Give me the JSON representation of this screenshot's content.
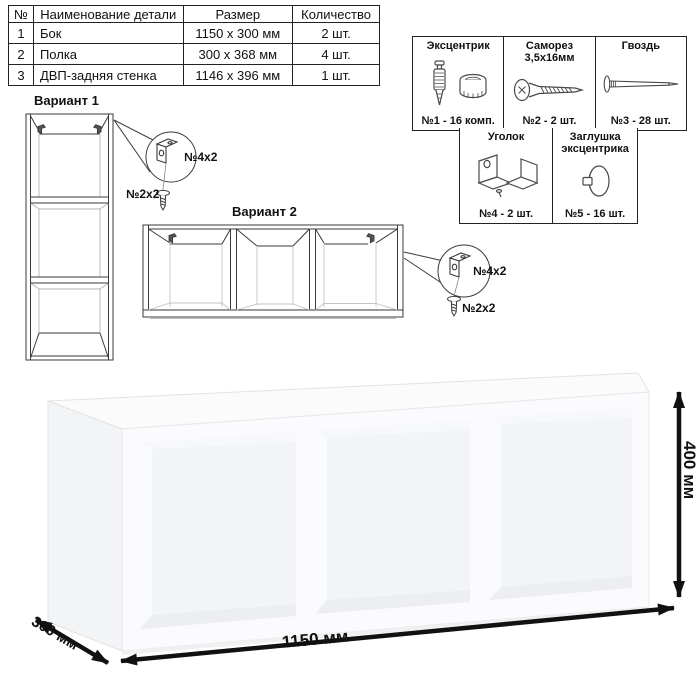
{
  "parts_table": {
    "headers": [
      "№",
      "Наименование детали",
      "Размер",
      "Количество"
    ],
    "rows": [
      [
        "1",
        "Бок",
        "1150 х 300 мм",
        "2 шт."
      ],
      [
        "2",
        "Полка",
        "300 х 368 мм",
        "4 шт."
      ],
      [
        "3",
        "ДВП-задняя стенка",
        "1146 х 396 мм",
        "1 шт."
      ]
    ]
  },
  "hardware_panel": {
    "items": [
      {
        "name": "Эксцентрик",
        "caption": "№1 - 16 комп.",
        "icon": "cam-lock-and-dowel-icon"
      },
      {
        "name": "Саморез 3,5х16мм",
        "caption": "№2 - 2 шт.",
        "icon": "screw-icon"
      },
      {
        "name": "Гвоздь",
        "caption": "№3 - 28 шт.",
        "icon": "nail-icon"
      },
      {
        "name": "Уголок",
        "caption": "№4 - 2 шт.",
        "icon": "corner-bracket-icon"
      },
      {
        "name": "Заглушка эксцентрика",
        "caption": "№5 - 16 шт.",
        "icon": "cam-cover-icon"
      }
    ]
  },
  "variants": {
    "variant1": {
      "label": "Вариант 1",
      "callout": {
        "bracket_qty": "№4х2",
        "screw_qty": "№2х2"
      }
    },
    "variant2": {
      "label": "Вариант 2",
      "callout": {
        "bracket_qty": "№4х2",
        "screw_qty": "№2х2"
      }
    }
  },
  "dimensions": {
    "width": "1150 мм",
    "depth": "300 мм",
    "height": "400 мм"
  },
  "colors": {
    "line": "#3a3a3a",
    "arrow": "#111111",
    "shelf_face": "#fbfbfd",
    "shelf_side": "#f3f4f5",
    "interior": "#f3f4f6"
  }
}
